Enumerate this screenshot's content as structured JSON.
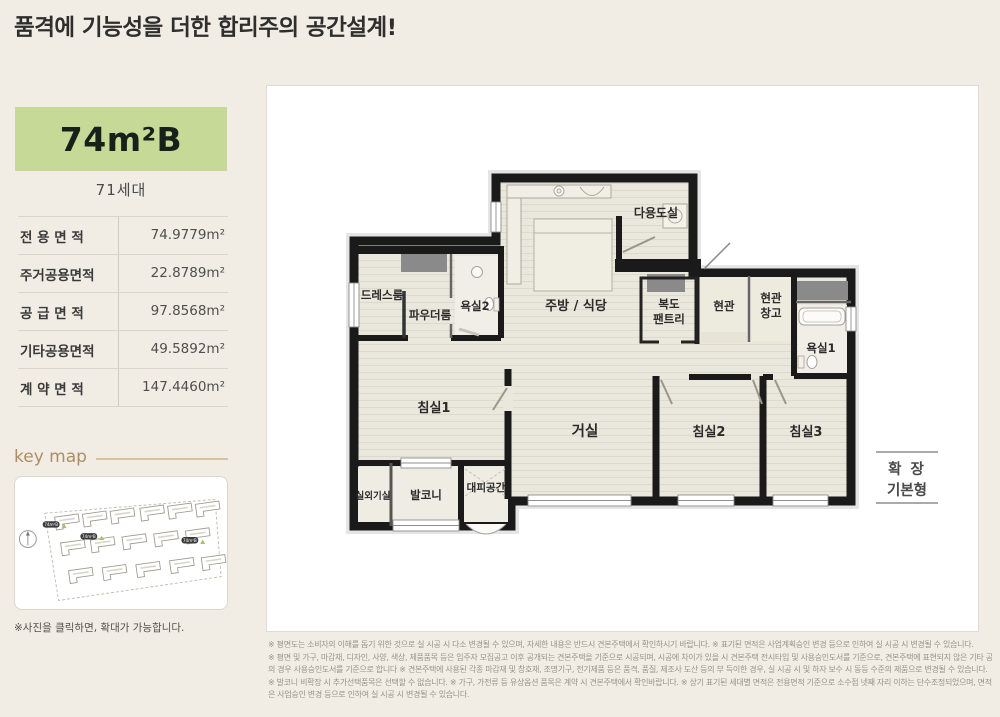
{
  "page": {
    "title": "품격에 기능성을 더한 합리주의 공간설계!"
  },
  "unit": {
    "size_label": "74m²B",
    "households": "71세대"
  },
  "area_table": {
    "rows": [
      {
        "label": "전 용 면 적",
        "value": "74.9779m²"
      },
      {
        "label": "주거공용면적",
        "value": "22.8789m²"
      },
      {
        "label": "공 급 면 적",
        "value": "97.8568m²"
      },
      {
        "label": "기타공용면적",
        "value": "49.5892m²"
      },
      {
        "label": "계 약 면 적",
        "value": "147.4460m²"
      }
    ]
  },
  "key_map": {
    "title": "key map",
    "badge_label": "74m²B",
    "caption": "※사진을 클릭하면, 확대가 가능합니다."
  },
  "floor_plan": {
    "rooms": {
      "dress_room": "드레스룸",
      "powder_room": "파우더룸",
      "bathroom2": "욕실2",
      "kitchen_dining": "주방 / 식당",
      "utility_room": "다용도실",
      "corridor": "복도",
      "pantry": "팬트리",
      "entrance": "현관",
      "entrance_storage_line1": "현관",
      "entrance_storage_line2": "창고",
      "bathroom1": "욕실1",
      "bedroom1": "침실1",
      "living_room": "거실",
      "bedroom2": "침실2",
      "bedroom3": "침실3",
      "outdoor_unit": "실외기실",
      "balcony": "발코니",
      "evacuation_space": "대피공간"
    },
    "variant": {
      "line1": "확 장",
      "line2": "기본형"
    }
  },
  "disclaimer": {
    "lines": [
      "※ 평면도는 소비자의 이해를 돕기 위한 것으로 실 시공 시 다소 변경될 수 있으며, 자세한 내용은 반드시 견본주택에서 확인하시기 바랍니다. ※ 표기된 면적은 사업계획승인 변경 등으로 인하여 실 시공 시 변경될 수 있습니다.",
      "※ 평면 및 가구, 마감재, 디자인, 사양, 색상, 제품품목 등은 입주자 모집공고 이후 공개되는 견본주택을 기준으로 시공되며, 시공에 차이가 있을 시 견본주택 전시타입 및 사용승인도서를 기준으로, 견본주택에 표현되지 않은 기타 공용부",
      "의 경우 사용승인도서를 기준으로 합니다 ※ 견본주택에 사용된 각종 마감재 및 창호재, 조명기구, 전기제품 등은 품격, 품질, 제조사 도산 등의 부 득이한 경우, 실 시공 시 및 하자 보수 시 동등 수준의 제품으로 변경될 수 있습니다.",
      "※ 발코니 비확장 시 추가선택품목은 선택할 수 없습니다. ※ 가구, 가전류 등 유상옵션 품목은 계약 시 견본주택에서 확인바랍니다. ※ 상기 표기된 세대별 면적은 전용면적 기준으로 소수점 넷째 자리 이하는 단수조정되었으며, 면적",
      "은 사업승인 변경 등으로 인하여 실 시공 시 변경될 수 있습니다."
    ]
  },
  "colors": {
    "background": "#f1ede4",
    "unit_badge_green": "#c6d996",
    "keymap_accent": "#ab8e62",
    "wall": "#1a1a1a",
    "floor": "#eae7dc"
  }
}
